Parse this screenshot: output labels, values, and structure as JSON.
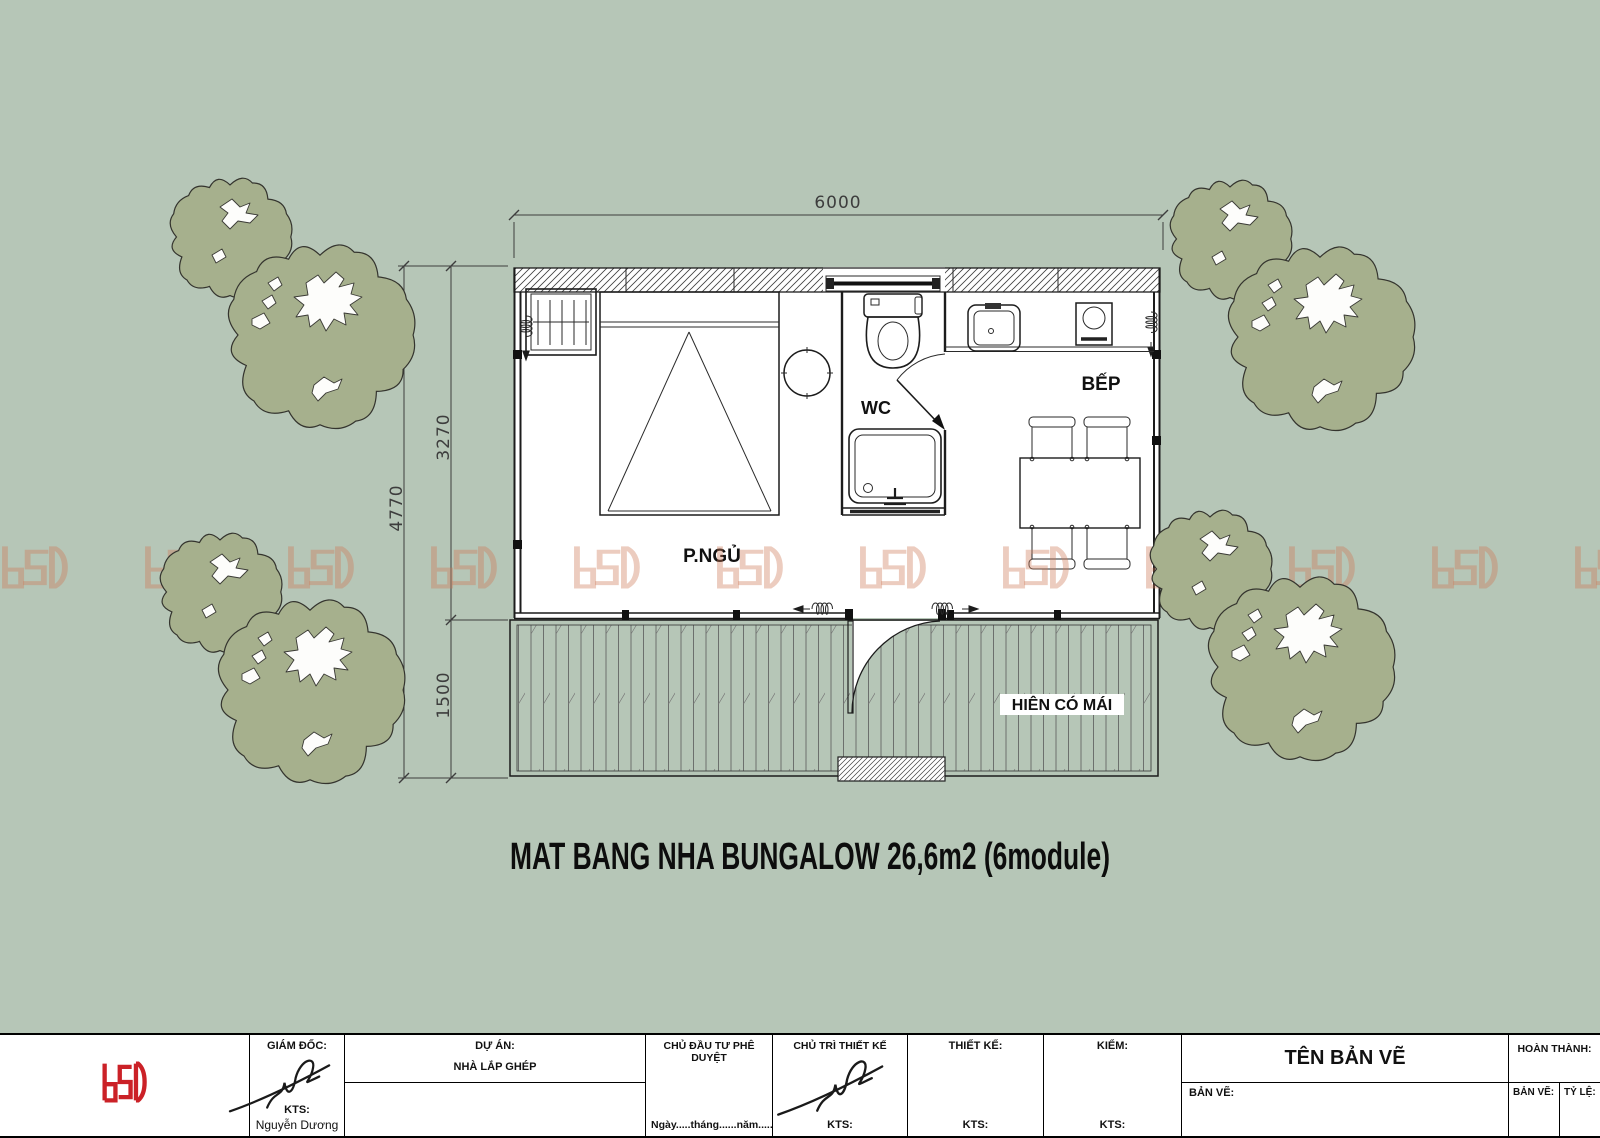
{
  "drawing": {
    "title": "MAT BANG NHA BUNGALOW 26,6m2 (6module)",
    "rooms": {
      "bedroom": "P.NGỦ",
      "wc": "WC",
      "kitchen": "BẾP",
      "porch": "HIÊN CÓ MÁI"
    },
    "dimensions": {
      "total_width": "6000",
      "main_depth": "3270",
      "total_depth": "4770",
      "porch_depth": "1500"
    }
  },
  "watermark": {
    "logo_text": "DSD"
  },
  "title_block": {
    "logo_text": "DSD",
    "director_label": "GIÁM ĐỐC:",
    "director_title": "KTS:",
    "director_name": "Nguyễn Dương",
    "project_label": "DỰ ÁN:",
    "project_name": "NHÀ LẮP GHÉP",
    "investor_label": "CHỦ ĐẦU TƯ PHÊ DUYỆT",
    "date_line": "Ngày.....tháng......năm.....",
    "lead_designer_label": "CHỦ TRÌ THIẾT KẾ",
    "lead_designer_title": "KTS:",
    "designer_label": "THIẾT KẾ:",
    "designer_title": "KTS:",
    "checker_label": "KIỂM:",
    "checker_title": "KTS:",
    "drawing_name_label": "TÊN BẢN VẼ",
    "drawing_label": "BẢN VẼ:",
    "completed_label": "HOÀN THÀNH:",
    "sheet_label": "BẢN VẼ:",
    "scale_label": "TỶ LỆ:"
  },
  "colors": {
    "background": "#b6c6b7",
    "tree": "#a6b08d",
    "logo_red": "#cb2127",
    "watermark": "rgba(205,122,88,0.38)"
  }
}
